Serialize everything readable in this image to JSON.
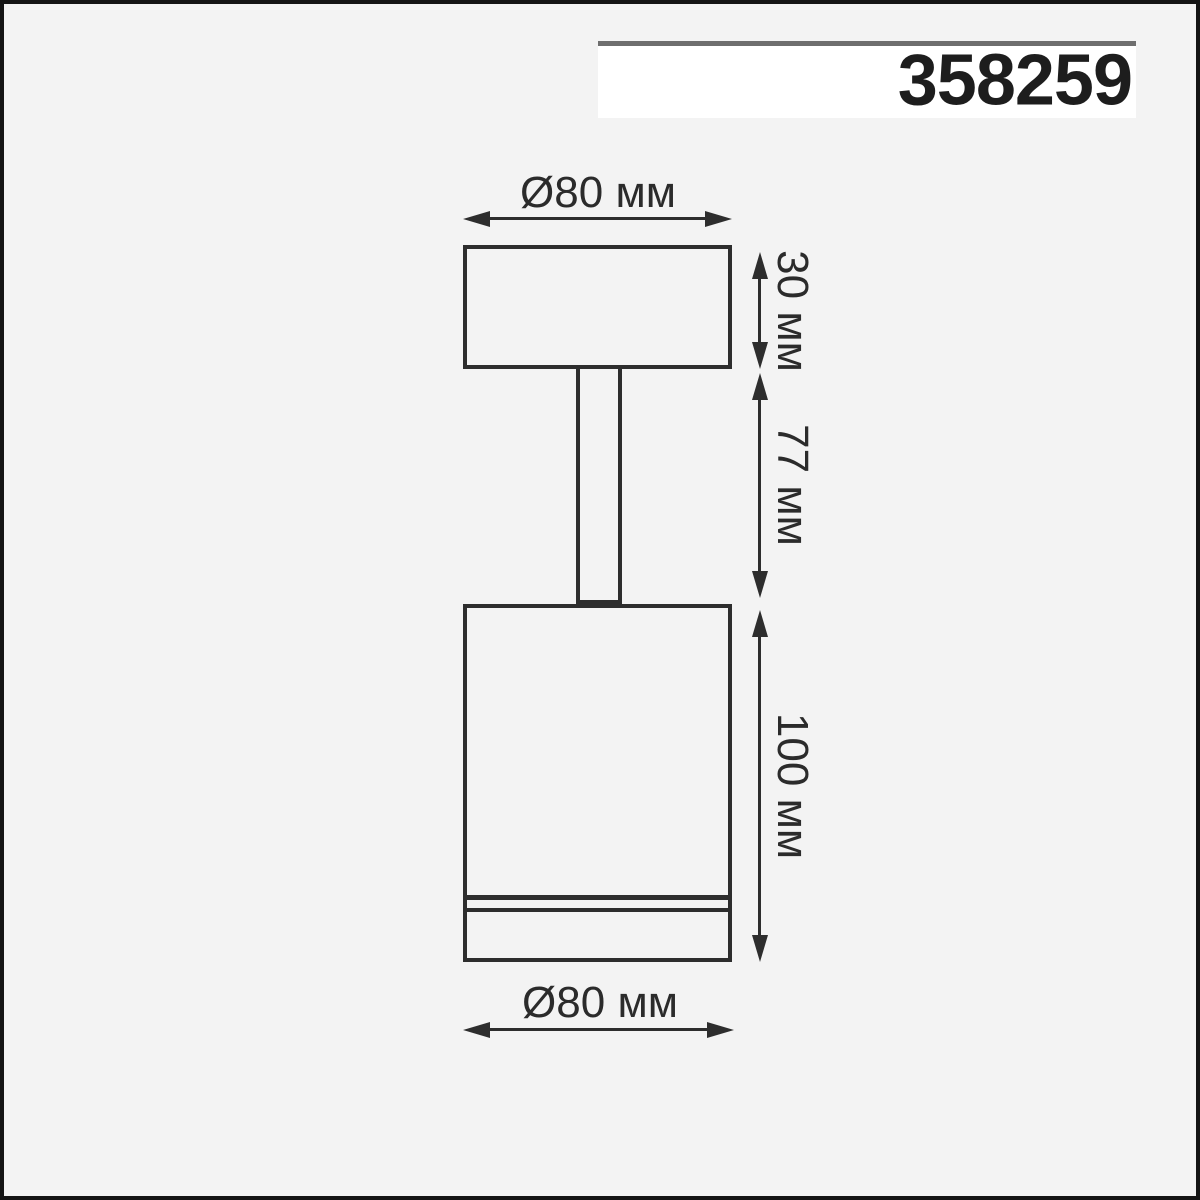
{
  "product_number": "358259",
  "dimensions": {
    "top_diameter": "Ø80 мм",
    "base_height": "30 мм",
    "stem_height": "77 мм",
    "body_height": "100 мм",
    "bottom_diameter": "Ø80 мм"
  },
  "colors": {
    "background": "#f3f3f3",
    "line": "#2d2d2d",
    "frame": "#141414",
    "badge_background": "#ffffff",
    "badge_top_rule": "#6e6e6e",
    "text": "#2b2b2b"
  }
}
